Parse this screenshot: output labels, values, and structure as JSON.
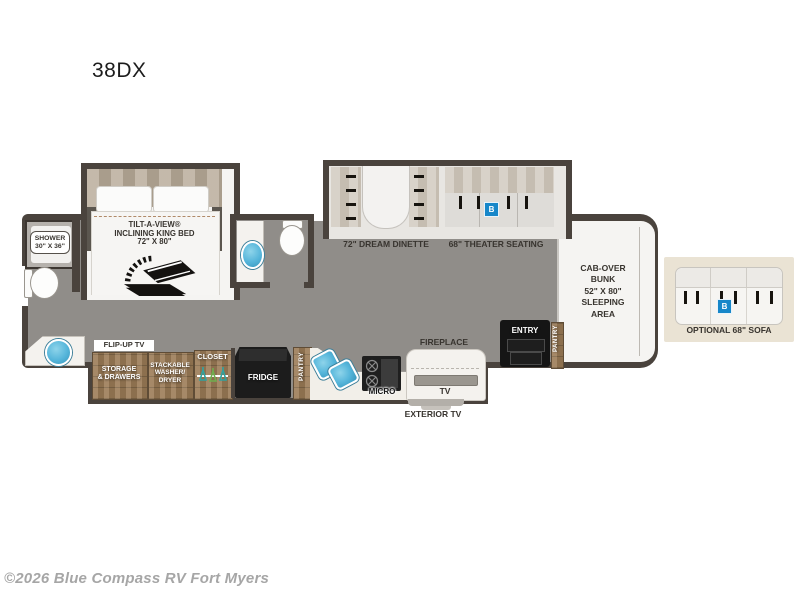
{
  "title": "38DX",
  "watermark": "©2026 Blue Compass RV Fort Myers",
  "bedroom": {
    "bed_line1": "TILT-A-VIEW®",
    "bed_line2": "INCLINING KING BED",
    "bed_line3": "72\" X 80\"",
    "flip_up_tv": "FLIP-UP TV"
  },
  "rear_bath": {
    "shower_line1": "SHOWER",
    "shower_line2": "30\" X 36\""
  },
  "living": {
    "dinette_label": "72\" DREAM DINETTE",
    "theater_label": "68\" THEATER SEATING",
    "theater_badge": "B",
    "fireplace_label": "FIREPLACE"
  },
  "galley": {
    "storage_line1": "STORAGE",
    "storage_line2": "& DRAWERS",
    "washer_line1": "STACKABLE",
    "washer_line2": "WASHER/",
    "washer_line3": "DRYER",
    "closet_label": "CLOSET",
    "fridge_label": "FRIDGE",
    "pantry_label": "PANTRY",
    "micro_label": "MICRO",
    "tv_label": "TV",
    "exterior_tv_label": "EXTERIOR TV"
  },
  "front": {
    "entry_label": "ENTRY",
    "pantry_label": "PANTRY",
    "cabover_line1": "CAB-OVER",
    "cabover_line2": "BUNK",
    "cabover_line3": "52\" X 80\"",
    "cabover_line4": "SLEEPING",
    "cabover_line5": "AREA"
  },
  "options": {
    "sofa_label": "OPTIONAL 68\" SOFA",
    "sofa_badge": "B"
  },
  "colors": {
    "wall": "#4a433d",
    "floor_gray": "#908d89",
    "cabinet_wood": "#9c7c57",
    "sink_blue": "#55b5da",
    "badge_blue": "#1787c9",
    "option_box_beige": "#eae3d4",
    "fixture_black": "#1c1c1c"
  }
}
